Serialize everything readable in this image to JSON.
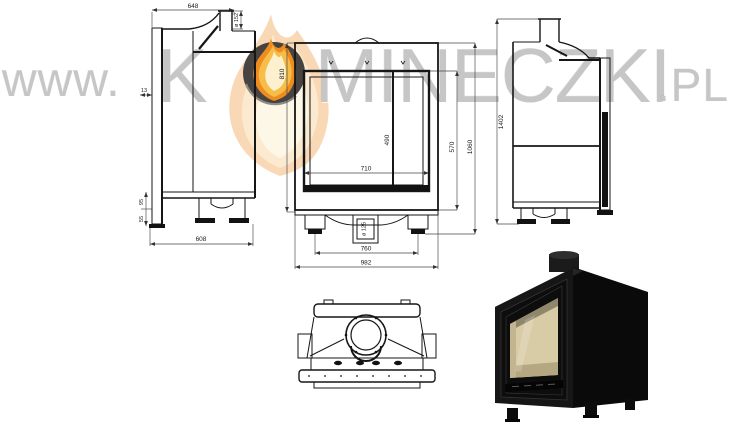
{
  "page": {
    "background": "#ffffff"
  },
  "watermark": {
    "url_prefix": "www.",
    "brand_initial": "K",
    "brand_rest": "MINECZKI",
    "domain_suffix": ".PL",
    "text_color": "#c6c6c6",
    "logo": {
      "icon": "flame-in-circle",
      "circle_color": "#474340",
      "flame_outer": "#ee8d1e",
      "flame_mid": "#f6bd49",
      "flame_core": "#fdf0cf"
    }
  },
  "drawing": {
    "line_color": "#161616",
    "dim_color": "#444444",
    "views": {
      "side_left": {
        "dims": {
          "width_top": "648",
          "flue": "ø 152",
          "offset": "13",
          "base_upper": "95",
          "base_lower": "55",
          "depth": "608"
        }
      },
      "front": {
        "dims": {
          "height": "810",
          "glass_width": "710",
          "glass_height": "490",
          "firebox_height": "570",
          "overall_height": "1060",
          "air_inlet": "ø 125",
          "feet_span": "760",
          "overall_width": "982"
        }
      },
      "side_right": {
        "dims": {
          "overall_height": "1402"
        }
      },
      "photo": {
        "body_color": "#0e0e0e",
        "glass_color": "#d8cca6"
      }
    }
  }
}
